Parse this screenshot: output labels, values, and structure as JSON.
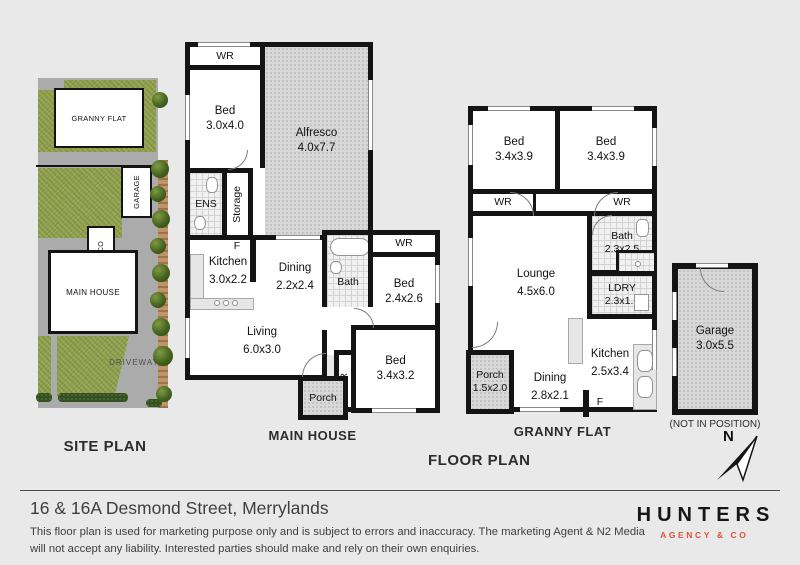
{
  "labels": {
    "site_plan": "SITE PLAN",
    "main_house": "MAIN HOUSE",
    "granny_flat": "GRANNY FLAT",
    "floor_plan": "FLOOR PLAN",
    "garage_note": "(NOT IN POSITION)",
    "north": "N"
  },
  "site": {
    "granny_flat": "GRANNY FLAT",
    "garage": "GARAGE",
    "alfresco": "ALFRESCO",
    "main_house": "MAIN HOUSE",
    "driveway": "DRIVEWAY"
  },
  "mh": {
    "wr_top": "WR",
    "bed1": {
      "name": "Bed",
      "size": "3.0x4.0"
    },
    "alfresco": {
      "name": "Alfresco",
      "size": "4.0x7.7"
    },
    "ens": "ENS",
    "storage": "Storage",
    "fridge": "F",
    "kitchen": {
      "name": "Kitchen",
      "size": "3.0x2.2"
    },
    "dining": {
      "name": "Dining",
      "size": "2.2x2.4"
    },
    "bath": "Bath",
    "wr_bed2": "WR",
    "bed2": {
      "name": "Bed",
      "size": "2.4x2.6"
    },
    "living": {
      "name": "Living",
      "size": "6.0x3.0"
    },
    "wr_bed3": "WR",
    "bed3": {
      "name": "Bed",
      "size": "3.4x3.2"
    },
    "porch": "Porch"
  },
  "gf": {
    "bed1": {
      "name": "Bed",
      "size": "3.4x3.9"
    },
    "bed2": {
      "name": "Bed",
      "size": "3.4x3.9"
    },
    "wr1": "WR",
    "wr2": "WR",
    "bath": {
      "name": "Bath",
      "size": "2.3x2.5"
    },
    "ldry": {
      "name": "LDRY",
      "size": "2.3x1.5"
    },
    "lounge": {
      "name": "Lounge",
      "size": "4.5x6.0"
    },
    "kitchen": {
      "name": "Kitchen",
      "size": "2.5x3.4"
    },
    "dining": {
      "name": "Dining",
      "size": "2.8x2.1"
    },
    "porch": {
      "name": "Porch",
      "size": "1.5x2.0"
    },
    "fridge": "F"
  },
  "garage": {
    "name": "Garage",
    "size": "3.0x5.5"
  },
  "footer": {
    "title": "16 & 16A Desmond Street, Merrylands",
    "disclaimer": "This floor plan is used for marketing purpose only and is subject to errors and inaccuracy. The marketing Agent & N2 Media will not accept any liability. Interested parties should make and rely on their own enquiries.",
    "logo_name": "HUNTERS",
    "logo_tagline": "AGENCY & CO"
  },
  "colors": {
    "background": "#e9e9e9",
    "wall": "#141414",
    "grass": "#93a24f",
    "paving": "#ababab",
    "hatch_fill": "#d8d8d8",
    "logo_accent": "#e2503d"
  }
}
